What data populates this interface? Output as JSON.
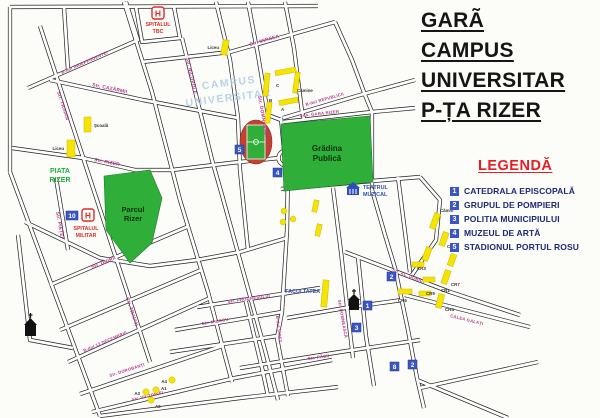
{
  "title": {
    "lines": [
      "GARÃ",
      "CAMPUS",
      "UNIVERSITAR",
      "P-ȚA RIZER"
    ]
  },
  "legend": {
    "title": "LEGENDĂ",
    "items": [
      {
        "num": "1",
        "label": "CATEDRALA EPISCOPALĂ"
      },
      {
        "num": "2",
        "label": "GRUPUL DE POMPIERI"
      },
      {
        "num": "3",
        "label": "POLITIA MUNICIPIULUI"
      },
      {
        "num": "4",
        "label": "MUZEUL DE ARTĂ"
      },
      {
        "num": "5",
        "label": "STADIONUL PORTUL ROSU"
      }
    ]
  },
  "map": {
    "watermark": {
      "line1": "CAMPUS",
      "line2": "UNIVERSITAR"
    },
    "areas": {
      "piata_rizer": {
        "line1": "PIATA",
        "line2": "RIZER"
      },
      "parcul_rizer": {
        "line1": "Parcul",
        "line2": "Rizer"
      },
      "gradina_publica": {
        "line1": "Grădina",
        "line2": "Publică"
      }
    },
    "pois": {
      "spitalul_tbc": {
        "line1": "SPITALUL",
        "line2": "TBC"
      },
      "spitalul_militar": {
        "line1": "SPITALUL",
        "line2": "MILITAR",
        "badge": "10"
      },
      "teatrul_muzical": {
        "line1": "TEATRUL",
        "line2": "MUZICAL"
      },
      "facultatea": "FACULTATEA",
      "scoala": "Școală",
      "liceu1": "Liceu",
      "liceu2": "Liceu",
      "camine": "Cămine",
      "campus_buildings": [
        "A",
        "B",
        "C"
      ]
    },
    "badges": [
      {
        "n": "1"
      },
      {
        "n": "2"
      },
      {
        "n": "3"
      },
      {
        "n": "4"
      },
      {
        "n": "5"
      },
      {
        "n": "10"
      },
      {
        "n": "8"
      },
      {
        "n": "2"
      }
    ],
    "streets": [
      {
        "name": "B-dul INDEPENDENTEI"
      },
      {
        "name": "Str. TRAIAN"
      },
      {
        "name": "Str. TRAIAN"
      },
      {
        "name": "Str. CAZĂRMII"
      },
      {
        "name": "Str. NICOPOLE"
      },
      {
        "name": "Str. MIRCEA"
      },
      {
        "name": "Str. DOMNEASCĂ"
      },
      {
        "name": "B-dul REPUBLICII"
      },
      {
        "name": "Șos. GARA RIZER"
      },
      {
        "name": "Str. RIZER"
      },
      {
        "name": "Str. PIEȚEI"
      },
      {
        "name": "Str. UNIRII"
      },
      {
        "name": "B-dul 13 DECEMBRIE"
      },
      {
        "name": "Str. DOROBANȚI"
      },
      {
        "name": "Str. VICTORIEI"
      },
      {
        "name": "Str. PROGRESULUI"
      },
      {
        "name": "Str. MILCOV"
      },
      {
        "name": "Str. PĂCII"
      },
      {
        "name": "B-dul SIRET"
      },
      {
        "name": "Str. DOMNEASCĂ"
      },
      {
        "name": "Str. AL. DONICI"
      },
      {
        "name": "CALEA GALAȚI"
      }
    ],
    "dorms": [
      "Cămin",
      "CR5",
      "CR3",
      "CR7",
      "CR9",
      "CR1",
      "CR6",
      "CR4"
    ],
    "stops": [
      "A1",
      "A2",
      "A3",
      "A4"
    ]
  },
  "colors": {
    "park_green": "#2fae3a",
    "street_label_magenta": "#b5338a",
    "badge_blue": "#3a56c5",
    "legend_navy": "#1e2a78",
    "legend_red": "#e31e24",
    "marker_yellow": "#f5e400",
    "watermark_blue": "#a9c9e6",
    "hospital_red": "#e02a28",
    "stadium_red": "#c24133"
  }
}
